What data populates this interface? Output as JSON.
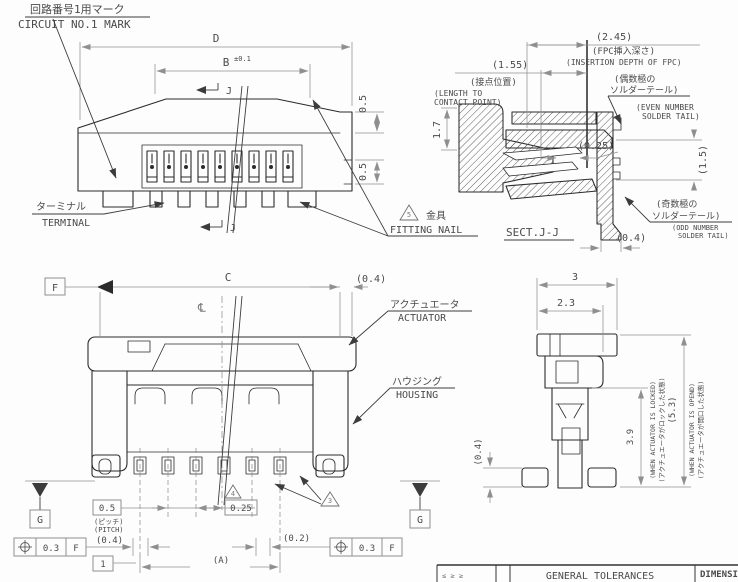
{
  "colors": {
    "line": "#2b2b2b",
    "dim": "#8f8f8f",
    "text": "#4a4a4a",
    "background": "#ffffff"
  },
  "top_view": {
    "circuit_jp": "回路番号1用マーク",
    "circuit_en": "CIRCUIT NO.1 MARK",
    "dim_d": "D",
    "dim_b": "B",
    "dim_b_tol": "±0.1",
    "j_top": "J",
    "j_bottom": "J",
    "dim_05_upper": "0.5",
    "dim_05_lower": "0.5",
    "terminal_jp": "ターミナル",
    "terminal_en": "TERMINAL",
    "nail_rev": "5",
    "nail_jp": "金具",
    "nail_en": "FITTING NAIL"
  },
  "section_view": {
    "dim_245": "(2.45)",
    "fpc_jp": "(FPC挿入深さ)",
    "fpc_en": "(INSERTION DEPTH OF FPC)",
    "dim_155": "(1.55)",
    "cp_jp": "(接点位置)",
    "cp_en1": "(LENGTH TO",
    "cp_en2": "CONTACT POINT)",
    "even_jp1": "(偶数極の",
    "even_jp2": "ソルダーテール)",
    "even_en1": "(EVEN NUMBER",
    "even_en2": "SOLDER TAIL)",
    "dim_17": "1.7",
    "dim_025": "(0.25)",
    "dim_15": "(1.5)",
    "odd_jp1": "(奇数極の",
    "odd_jp2": "ソルダーテール)",
    "odd_en1": "(ODD NUMBER",
    "odd_en2": "SOLDER TAIL)",
    "dim_04": "(0.4)",
    "title": "SECT.J-J"
  },
  "front_view": {
    "datum_f": "F",
    "dim_c": "C",
    "dim_04_top": "(0.4)",
    "centerline": "℄",
    "actuator_jp": "アクチュエータ",
    "actuator_en": "ACTUATOR",
    "housing_jp": "ハウジング",
    "housing_en": "HOUSING",
    "datum_g": "G",
    "fcf_tol": "0.3",
    "fcf_datum": "F",
    "dim_05_box": "0.5",
    "pitch_jp": "(ピッチ)",
    "pitch_en": "(PITCH)",
    "dim_04_left": "(0.4)",
    "dim_025_box": "0.25",
    "rev4": "4",
    "rev3": "3",
    "dim_02": "(0.2)",
    "dim_a": "(A)",
    "dim_1_box": "1"
  },
  "side_view": {
    "dim_3": "3",
    "dim_23": "2.3",
    "dim_39": "3.9",
    "locked_en": "(WHEN ACTUATOR IS LOCKED)",
    "locked_jp": "(アクチュエータがロックした状態)",
    "dim_53": "(5.3)",
    "opened_en": "(WHEN ACTUATOR IS OPEND)",
    "opened_jp": "(アクチュエータが開口した状態)",
    "dim_04": "(0.4)"
  },
  "title_block": {
    "range_marks": "≤ ≥ ≥",
    "general": "GENERAL TOLERANCES",
    "dimensions_label": "DIMENSI"
  }
}
